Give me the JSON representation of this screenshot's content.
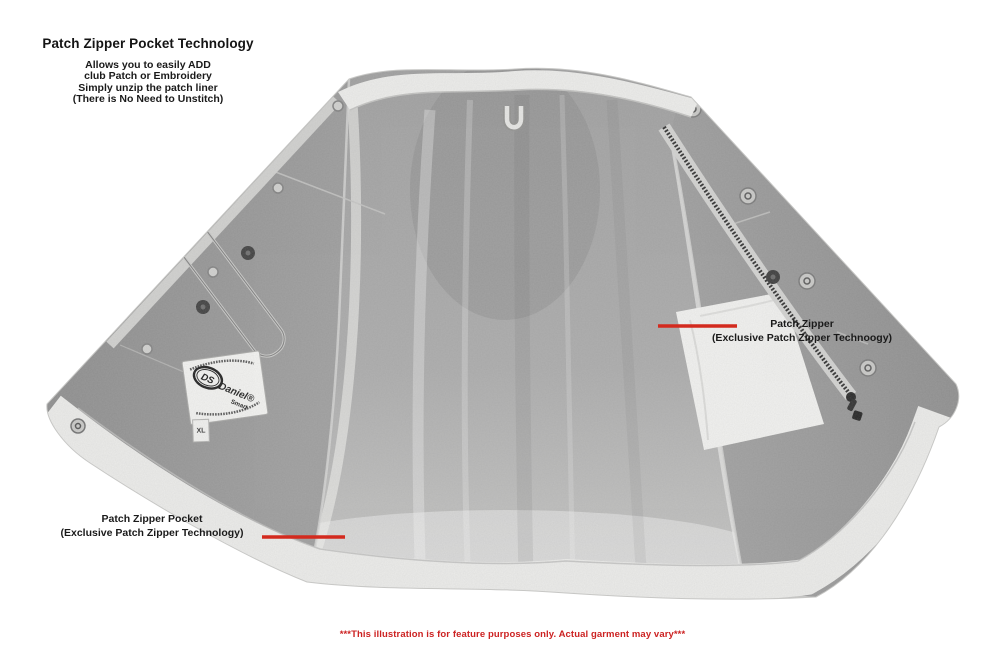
{
  "header": {
    "title": "Patch Zipper Pocket Technology",
    "description_lines": [
      "Allows you to easily ADD",
      "club Patch or Embroidery",
      "Simply unzip the patch liner",
      "(There is No Need to Unstitch)"
    ]
  },
  "annotations": {
    "patch_zipper": {
      "line1": "Patch Zipper",
      "line2": "(Exclusive Patch Zipper Technoogy)"
    },
    "patch_zipper_pocket": {
      "line1": "Patch Zipper Pocket",
      "line2": "(Exclusive Patch Zipper Technology)"
    }
  },
  "garment_label": {
    "logo": "DS",
    "brand": "Daniel®",
    "brand2": "Smart",
    "size_tag": "XL"
  },
  "footer": {
    "disclaimer": "***This illustration is for feature purposes only. Actual garment may vary***"
  },
  "colors": {
    "annotation_red": "#cc2222",
    "callout_line_red": "#d32a1e",
    "text_black": "#1a1a1a",
    "fabric_gray": "#8f8f8f",
    "lining_light": "#c6c6c6",
    "trim_white": "#ececea"
  }
}
